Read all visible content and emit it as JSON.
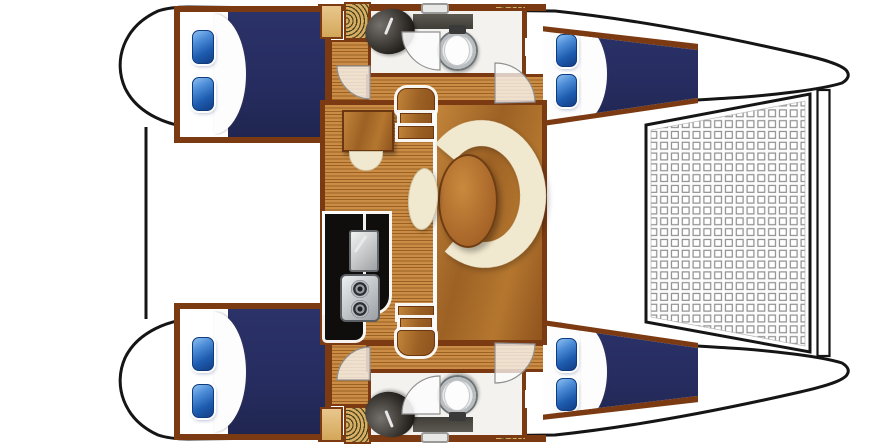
{
  "page": {
    "title": "Catamaran deck floor plan (top view)"
  },
  "colors": {
    "outline": "#151515",
    "trim": "#7c3a12",
    "wood-light": "#c2843a",
    "wood-dark": "#8f531d",
    "teak-light": "#cb8d45",
    "teak-dark": "#9a6122",
    "slat-tan": "#d9ad62",
    "navy": "#262c5f",
    "cream": "#f1e9cf",
    "counter-black": "#0f0e0c",
    "counter-gray": "#524f47",
    "bath-floor": "#f3f2ef",
    "bg": "#ffffff"
  },
  "plan": {
    "vessel": "catamaran",
    "view": "top-down interior layout",
    "orientation": {
      "bow": "right",
      "stern": "left"
    },
    "hulls": [
      {
        "name": "port hull (top)",
        "rooms": [
          {
            "name": "aft double cabin",
            "berth": "double",
            "pillows": 2,
            "bedding": "navy with white sheet"
          },
          {
            "name": "head",
            "fixtures": [
              "oval sink",
              "vanity counter",
              "toilet",
              "swing door"
            ]
          },
          {
            "name": "forward double cabin",
            "berth": "double",
            "pillows": 2,
            "bedding": "navy with white sheet"
          }
        ],
        "companionway_ladders": 2,
        "deck_hatches": 1
      },
      {
        "name": "starboard hull (bottom)",
        "rooms": [
          {
            "name": "aft double cabin",
            "berth": "double",
            "pillows": 2,
            "bedding": "navy with white sheet"
          },
          {
            "name": "head",
            "fixtures": [
              "oval sink",
              "vanity counter",
              "toilet",
              "swing door"
            ]
          },
          {
            "name": "forward double cabin",
            "berth": "double",
            "pillows": 2,
            "bedding": "navy with white sheet"
          }
        ],
        "companionway_ladders": 2,
        "deck_hatches": 1
      }
    ],
    "bridgedeck": {
      "saloon": {
        "settee": "C-shaped cream settee",
        "table": "oval wood dining table",
        "stool": "oval cream stool",
        "nav_station": "chart desk with half-round seat",
        "companionway_steps": "two step flights to each hull"
      },
      "galley": {
        "counter": "black L-shaped counter",
        "appliances": [
          "square sink with faucet",
          "two-burner stove"
        ]
      },
      "flooring": [
        "teak plank decking",
        "solid wood panel"
      ]
    },
    "foredeck": {
      "trampoline": "square-mesh net between bows",
      "forward_crossbeam": true
    },
    "door_swings": 6
  }
}
